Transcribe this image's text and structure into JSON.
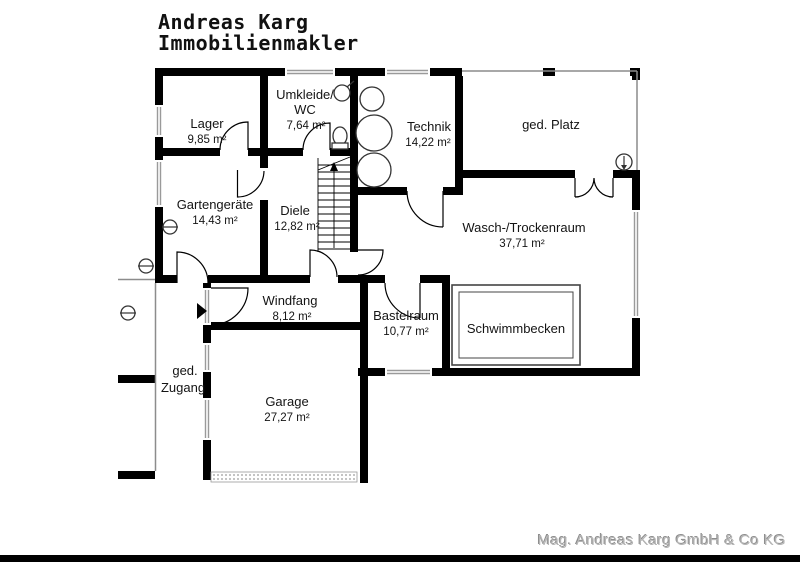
{
  "header": {
    "line1": "Andreas Karg",
    "line2": "Immobilienmakler"
  },
  "rooms": {
    "lager": {
      "label": "Lager",
      "area": "9,85 m²"
    },
    "umkleide": {
      "label1": "Umkleide/",
      "label2": "WC",
      "area": "7,64 m²"
    },
    "technik": {
      "label": "Technik",
      "area": "14,22 m²"
    },
    "ged_platz": {
      "label": "ged. Platz"
    },
    "gartengeraete": {
      "label": "Gartengeräte",
      "area": "14,43 m²"
    },
    "diele": {
      "label": "Diele",
      "area": "12,82 m²"
    },
    "wasch": {
      "label": "Wasch-/Trockenraum",
      "area": "37,71 m²"
    },
    "windfang": {
      "label": "Windfang",
      "area": "8,12 m²"
    },
    "bastelraum": {
      "label": "Bastelraum",
      "area": "10,77 m²"
    },
    "schwimmbecken": {
      "label": "Schwimmbecken"
    },
    "ged_zugang": {
      "label1": "ged.",
      "label2": "Zugang"
    },
    "garage": {
      "label": "Garage",
      "area": "27,27 m²"
    }
  },
  "footer": {
    "company": "Mag. Andreas Karg GmbH & Co KG"
  },
  "colors": {
    "wall": "#000000",
    "window_line": "#9a9a9a",
    "text": "#141414",
    "footer_text": "#b5b5b5"
  }
}
